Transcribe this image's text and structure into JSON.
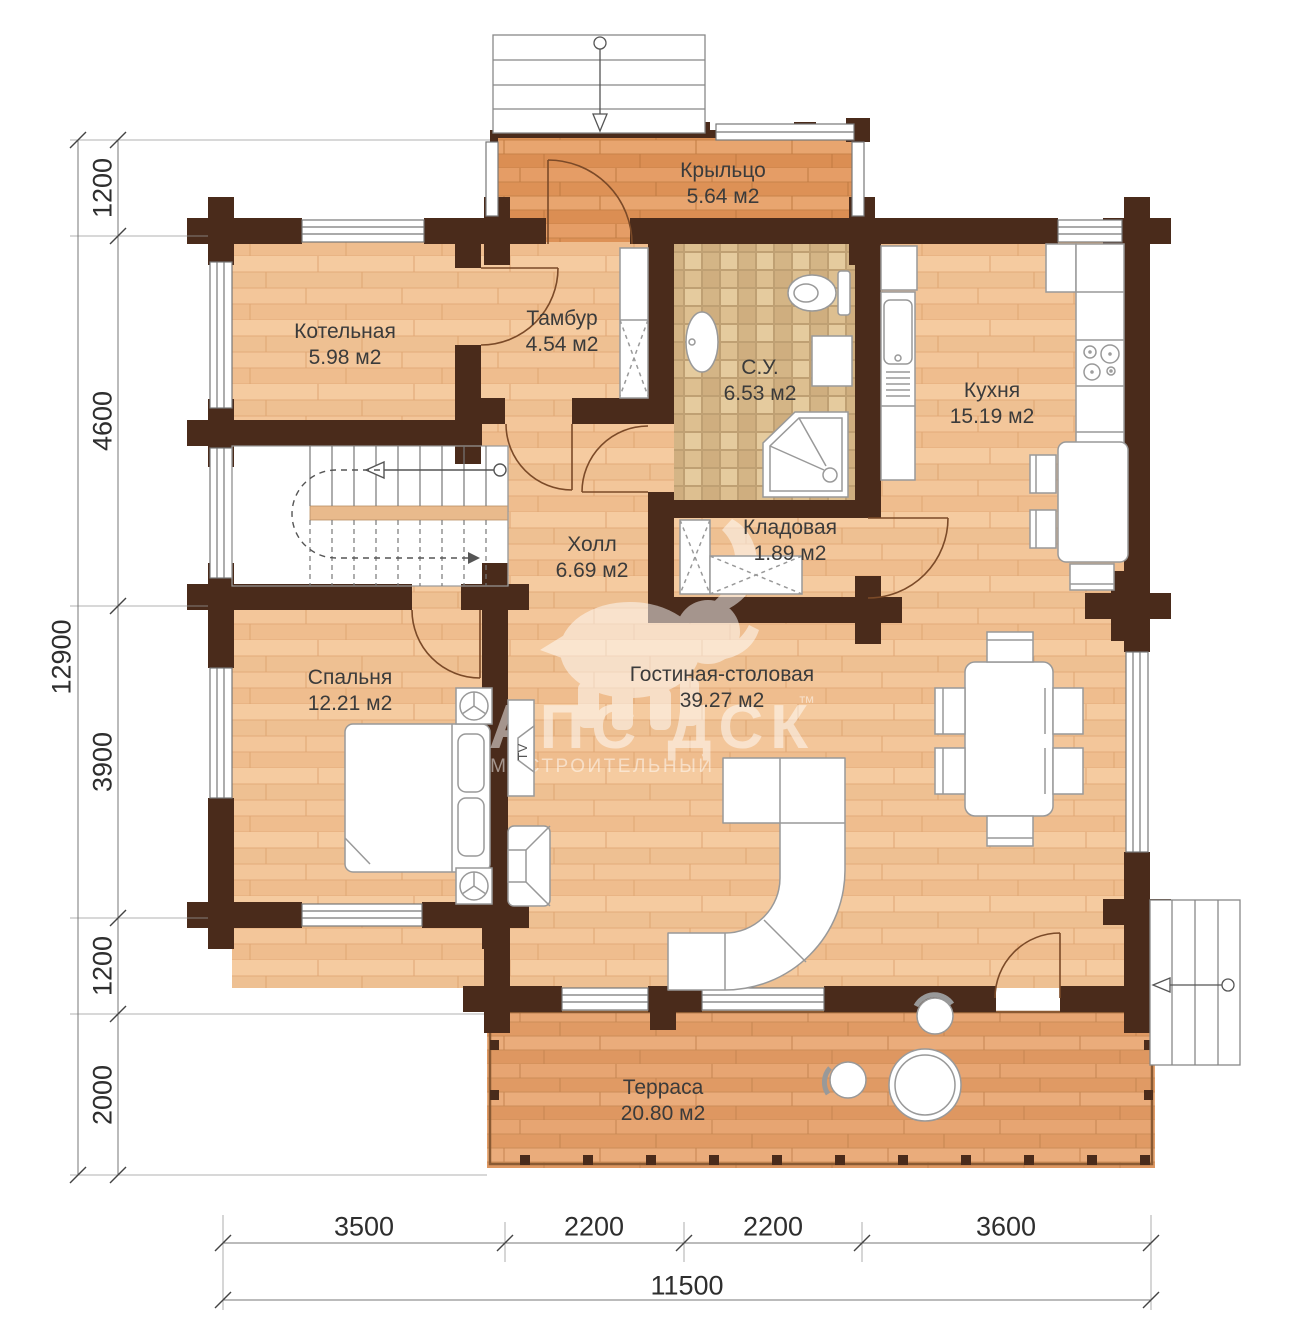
{
  "plan_title": "План 1 этажа",
  "rooms": [
    {
      "id": "porch",
      "name": "Крыльцо",
      "area": "5.64 м2"
    },
    {
      "id": "boiler",
      "name": "Котельная",
      "area": "5.98 м2"
    },
    {
      "id": "vestibule",
      "name": "Тамбур",
      "area": "4.54 м2"
    },
    {
      "id": "bathroom",
      "name": "С.У.",
      "area": "6.53 м2"
    },
    {
      "id": "kitchen",
      "name": "Кухня",
      "area": "15.19 м2"
    },
    {
      "id": "hall",
      "name": "Холл",
      "area": "6.69 м2"
    },
    {
      "id": "storage",
      "name": "Кладовая",
      "area": "1.89 м2"
    },
    {
      "id": "bedroom",
      "name": "Спальня",
      "area": "12.21 м2"
    },
    {
      "id": "living",
      "name": "Гостиная-столовая",
      "area": "39.27 м2"
    },
    {
      "id": "terrace",
      "name": "Терраса",
      "area": "20.80 м2"
    }
  ],
  "dimensions": {
    "left_chain": [
      "1200",
      "4600",
      "3900",
      "1200",
      "2000"
    ],
    "left_total": "12900",
    "bottom_chain": [
      "3500",
      "2200",
      "2200",
      "3600"
    ],
    "bottom_total": "11500"
  },
  "furniture_labels": {
    "tv": "TV"
  },
  "watermark": {
    "brand": "АПС ДСК",
    "tm": "™",
    "subtitle": "ДОМОСТРОИТЕЛЬНЫЙ КОМБИНАТ"
  },
  "colors": {
    "wall": "#4a2b1b",
    "floor_interior": "#f3c79b",
    "floor_exterior": "#e09a62",
    "bathroom_tile": "#dcc092",
    "furniture_outline": "#999999",
    "dimension_text": "#2e2e2e",
    "watermark": "#ffffff"
  }
}
